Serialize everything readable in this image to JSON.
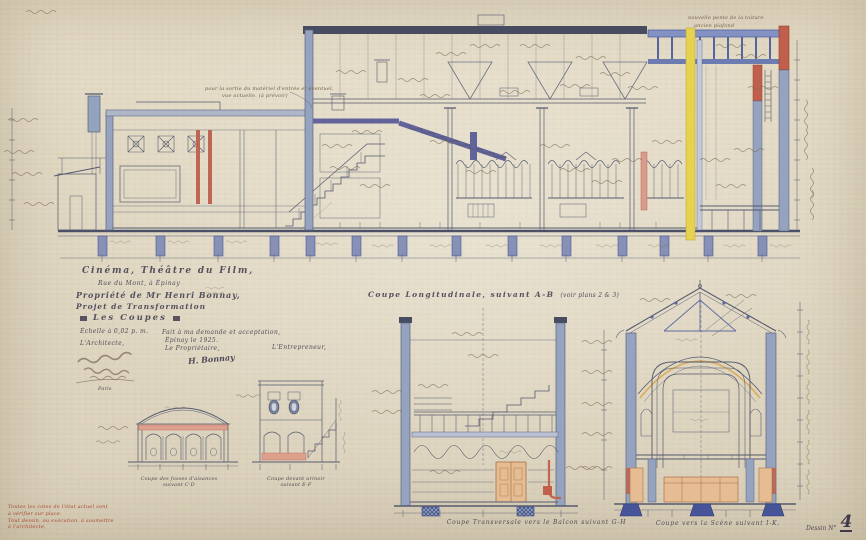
{
  "sheet": {
    "type": "architectural section drawing",
    "paper_color": "#e9e1cd",
    "ink_color": "#555a6e",
    "accent_colors": {
      "wall_blue_wash": "#96a3be",
      "steel_violet": "#62639b",
      "masonry_red": "#bf6553",
      "safety_curtain_yellow": "#e7d24f",
      "foundation_navy": "#46549b",
      "wood_orange": "#e6bd92",
      "note_red": "#a8452e"
    }
  },
  "title_block": {
    "line1": "Cinéma, Théâtre du Film,",
    "line2": "Rue du Mont, à Épinay",
    "line3": "Propriété de Mr Henri Bonnay,",
    "line4": "Projet de Transformation",
    "line5": "Les Coupes",
    "scale": "Échelle à 0,02 p. m.",
    "architect_label": "L'Architecte,",
    "architect_city": "Paris",
    "approval_line": "Fait à ma demande et acceptation,",
    "date_line": "Épinay le            1925.",
    "owner_label": "Le Propriétaire,",
    "owner_signature": "H. Bonnay",
    "contractor_label": "L'Entrepreneur,"
  },
  "section_labels": {
    "main": "Coupe Longitudinale, suivant A-B",
    "main_note": "(voir plans 2 & 3)",
    "cd_line1": "Coupe des fosses d'aisances",
    "cd_line2": "suivant C-D",
    "ef_line1": "Coupe devant urinoir",
    "ef_line2": "suivant E-F",
    "gh": "Coupe Transversale vers le Balcon suivant G-H",
    "ik": "Coupe vers la Scène suivant I-K.",
    "drawing_no_label": "Dessin N°",
    "drawing_no": "4"
  },
  "annotations": {
    "material_note_l1": "pour la sortie du matériel d'entrée et éventuel,",
    "material_note_l2": "vue actuelle. (à prévoir)",
    "roof_slope": "nouvelle pente de la toiture",
    "old_ceiling": "ancien plafond"
  },
  "footnote": {
    "line1": "Toutes les cotes de l'état actuel sont",
    "line2": "à vérifier sur place.",
    "line3": "Tout dessin, ou exécution, à soumettre",
    "line4": "à l'architecte."
  }
}
